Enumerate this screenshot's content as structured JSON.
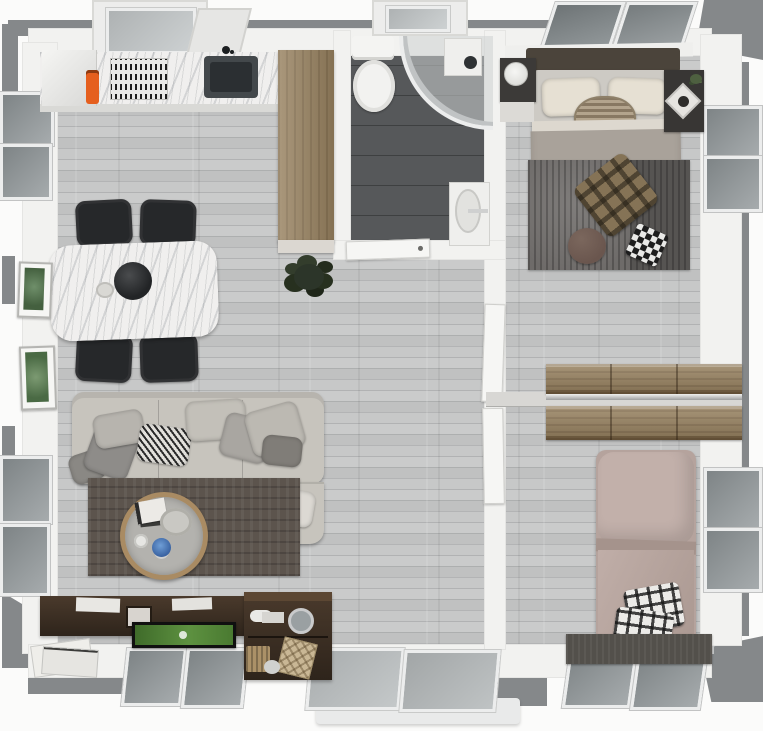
{
  "scene": {
    "type": "3d-floor-plan-top-view",
    "id": "two-bedroom-apartment-render"
  },
  "palette": {
    "bg": "#fbfbfa",
    "outer_wall": "#85888a",
    "wall": "#f2f2f0",
    "door": "#f6f6f4",
    "frame": "#eceded",
    "floor": "#bcbdbd",
    "bath_floor": "#56585a",
    "marble": "#f0efee",
    "wood": "#97815f",
    "espresso": "#2e241b",
    "chair": "#26282a",
    "sofa": "#c7c4bd",
    "rug_living": "#5c544d",
    "rug_bedroom": "#6e6b69",
    "table_ring": "#a98b63",
    "orange": "#e55f1e",
    "plant": "#2c3529",
    "tv_screen": "#4e7d33",
    "headboard": "#4b443b",
    "mattress": "#cdcac4",
    "blanket": "#a9a29a",
    "pillow_cream": "#e6e0d3",
    "bed2": "#b5a39d",
    "plaid_tan": "#857356",
    "pouf": "#6a564e",
    "porch": "#e9eaea"
  },
  "rooms": {
    "kitchen_dining": {
      "id": "kitchen-dining",
      "items": [
        "kitchen-counter",
        "fridge",
        "cooktop",
        "kitchen-sink",
        "range-hood-window",
        "tall-wood-cabinet",
        "orange-bottle",
        "dining-table",
        "center-bowl",
        "dining-chairs-x4",
        "botanical-art-x2",
        "floor-plant"
      ]
    },
    "bathroom": {
      "id": "bathroom",
      "items": [
        "toilet",
        "corner-shower",
        "shower-fixture",
        "bathroom-sink",
        "bathroom-door",
        "bathroom-window"
      ]
    },
    "bedroom_main": {
      "id": "bedroom-main",
      "items": [
        "double-bed",
        "headboard",
        "pillows-x2",
        "wicker-basket",
        "nightstand-left",
        "table-lamp",
        "nightstand-right",
        "decor-tray",
        "area-rug",
        "plaid-throw",
        "round-pouf",
        "checkered-pillow",
        "skylight-windows"
      ]
    },
    "closet_hall": {
      "id": "closet-hall",
      "items": [
        "wood-dresser-upper",
        "wood-dresser-lower",
        "wall-ledge",
        "interior-door-1",
        "interior-door-2"
      ]
    },
    "bedroom_second": {
      "id": "bedroom-second",
      "items": [
        "single-bed",
        "plaid-pillows-x2",
        "foot-bench",
        "side-windows",
        "bottom-windows"
      ]
    },
    "living": {
      "id": "living-room",
      "items": [
        "sectional-sofa",
        "chaise",
        "throw-pillows",
        "area-rug",
        "round-coffee-table",
        "book",
        "serving-tray",
        "blue-cup",
        "tv-console",
        "tv-flatscreen",
        "desk",
        "desk-lamp",
        "baskets",
        "magazines"
      ]
    },
    "entry": {
      "id": "entry",
      "items": [
        "sliding-glass-door",
        "porch-step"
      ]
    }
  }
}
